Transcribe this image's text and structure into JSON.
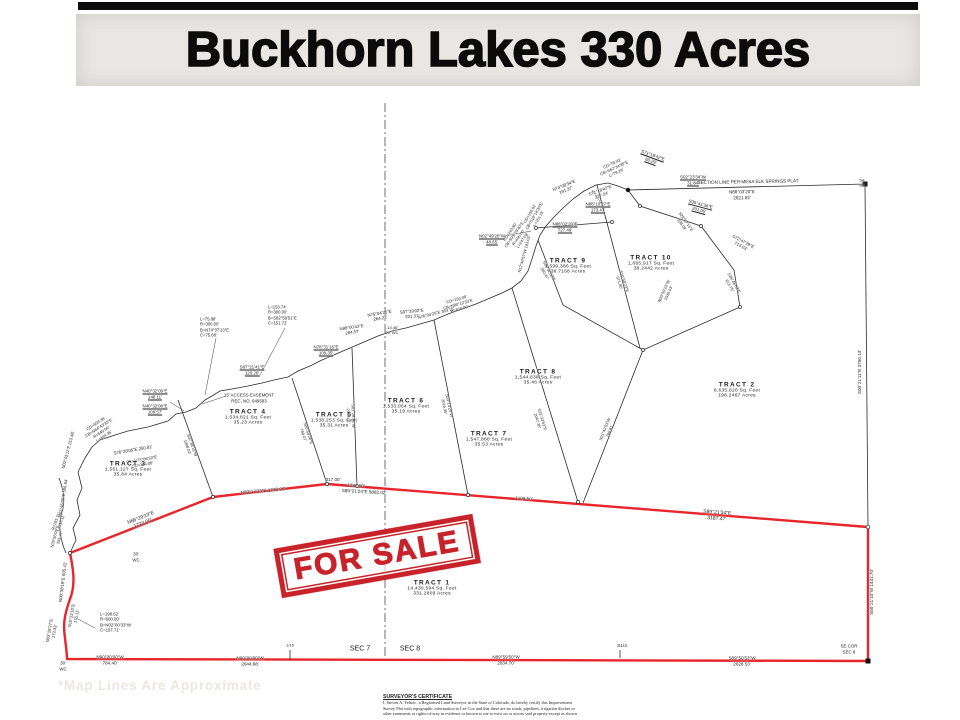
{
  "title": "Buckhorn Lakes 330 Acres",
  "stamp_text": "FOR SALE",
  "watermark": "*Map Lines Are Approximate",
  "colors": {
    "boundary_red": "#e8252a",
    "stamp_red": "#c8232a",
    "line_black": "#2a2a2a",
    "banner_gray": "#e9e7e3",
    "watermark_gray": "#ebe8e4"
  },
  "certificate": {
    "heading": "SURVEYOR'S CERTIFICATE",
    "lines": [
      "I, Steven A. Yelton , a Registered Land Surveyor in the State of Colorado, do hereby certify this Improvement",
      "Survey Plat with topographic information to Lee Cox and that there are no roads, pipelines, irrigation ditches or",
      "other easements or rights-of-way in evidence or known to me to exist on or across said property except as shown"
    ]
  },
  "tracts": [
    {
      "name": "TRACT  1",
      "sqft": "14,430,594  Sq. Feet",
      "acres": "331.2809  Acres",
      "x": 432,
      "y": 588
    },
    {
      "name": "TRACT  2",
      "sqft": "8,635,626  Sq. Feet",
      "acres": "198.2467  Acres",
      "x": 737,
      "y": 390
    },
    {
      "name": "TRACT  3",
      "sqft": "1,561,127  Sq. Feet",
      "acres": "35.84  Acres",
      "x": 128,
      "y": 469
    },
    {
      "name": "TRACT  4",
      "sqft": "1,534,821  Sq. Feet",
      "acres": "35.23  Acres",
      "x": 248,
      "y": 417
    },
    {
      "name": "TRACT  5",
      "sqft": "1,538,253  Sq. Feet",
      "acres": "35.31  Acres",
      "x": 334,
      "y": 420
    },
    {
      "name": "TRACT  6",
      "sqft": "1,533,054  Sq. Feet",
      "acres": "35.19  Acres",
      "x": 406,
      "y": 406
    },
    {
      "name": "TRACT  7",
      "sqft": "1,547,888  Sq. Feet",
      "acres": "35.53  Acres",
      "x": 489,
      "y": 439
    },
    {
      "name": "TRACT  8",
      "sqft": "1,544,838  Sq. Feet",
      "acres": "35.46  Acres",
      "x": 538,
      "y": 377
    },
    {
      "name": "TRACT  9",
      "sqft": "1,599,386  Sq. Feet",
      "acres": "36.7168  Acres",
      "x": 568,
      "y": 266
    },
    {
      "name": "TRACT 10",
      "sqft": "1,665,917  Sq. Feet",
      "acres": "38.2442  Acres",
      "x": 651,
      "y": 263
    }
  ],
  "labels": [
    {
      "t": "N66°29'23\"E\n1722.00'",
      "x": 142,
      "y": 521,
      "r": -21,
      "s": 5
    },
    {
      "t": "N89°17'33\"E  1236.98'",
      "x": 263,
      "y": 491,
      "r": -5,
      "s": 4.6
    },
    {
      "t": "317.00'",
      "x": 333,
      "y": 480,
      "r": 0,
      "s": 4.6
    },
    {
      "t": "1286.00'",
      "x": 356,
      "y": 486,
      "r": 3,
      "s": 4.6
    },
    {
      "t": "S89°21'24\"E  5882.02'",
      "x": 364,
      "y": 492,
      "r": 3,
      "s": 4.6
    },
    {
      "t": "1109.50'",
      "x": 524,
      "y": 499,
      "r": 3,
      "s": 4.6
    },
    {
      "t": "S89°21'34\"E\n3187.47'",
      "x": 717,
      "y": 516,
      "r": 4,
      "s": 5
    },
    {
      "t": "S00°21'10\"W  1441.70'",
      "x": 872,
      "y": 592,
      "r": -90,
      "s": 4.6
    },
    {
      "t": "S00°21'11\"E  3750.13'",
      "x": 860,
      "y": 372,
      "r": -90,
      "s": 4.6
    },
    {
      "t": "N90°00'00\"W\n784.40'",
      "x": 110,
      "y": 660,
      "r": 0,
      "s": 4.6
    },
    {
      "t": "N90°00'00\"W\n2644.88'",
      "x": 250,
      "y": 661,
      "r": 0,
      "s": 4.6
    },
    {
      "t": "N89°59'50\"W\n2834.70'",
      "x": 506,
      "y": 660,
      "r": 0,
      "s": 4.6
    },
    {
      "t": "S1/4",
      "x": 622,
      "y": 647,
      "r": 0,
      "s": 4.8
    },
    {
      "t": "S89°50'53\"W\n2628.53'",
      "x": 742,
      "y": 661,
      "r": 0,
      "s": 4.6
    },
    {
      "t": "SE  COR\nSEC  8",
      "x": 849,
      "y": 649,
      "r": 0,
      "s": 4.4
    },
    {
      "t": "SEC  7",
      "x": 360,
      "y": 650,
      "r": 0,
      "s": 7
    },
    {
      "t": "SEC  8",
      "x": 410,
      "y": 650,
      "r": 0,
      "s": 7
    },
    {
      "t": "30'\nWC",
      "x": 63,
      "y": 666,
      "r": 0,
      "s": 4.4
    },
    {
      "t": "1/16",
      "x": 290,
      "y": 646,
      "r": 0,
      "s": 3.8
    },
    {
      "t": "N00°38'19\"E  505.41'",
      "x": 63,
      "y": 582,
      "r": -83,
      "s": 4.4
    },
    {
      "t": "N10°23'10\"E\n175.11'",
      "x": 74,
      "y": 616,
      "r": -80,
      "s": 4.2
    },
    {
      "t": "N03°28'27\"E\n173.33'",
      "x": 52,
      "y": 631,
      "r": -80,
      "s": 4.2
    },
    {
      "t": "L=198.62'\nR=600.00'\nB=N02°00'33\"W\nC=197.71'",
      "x": 100,
      "y": 622,
      "r": 0,
      "s": 4.3,
      "a": "l"
    },
    {
      "t": "30'\nWC",
      "x": 136,
      "y": 557,
      "r": 0,
      "s": 4.4
    },
    {
      "t": "R=281.31'\nL=216.11'",
      "x": 58,
      "y": 522,
      "r": -70,
      "s": 4
    },
    {
      "t": "N03°46'00\"E  506.94'",
      "x": 63,
      "y": 498,
      "r": -80,
      "s": 4.2
    },
    {
      "t": "N02°43'11\"E  213.48'",
      "x": 68,
      "y": 450,
      "r": -75,
      "s": 4.2
    },
    {
      "t": "N25°56'09\"E\n355.47'",
      "x": 57,
      "y": 537,
      "r": -75,
      "s": 4
    },
    {
      "t": "CD=503.36'\nCB=N64°43'33\"E\nR=540.00'\nL=444.35'",
      "x": 100,
      "y": 430,
      "r": -33,
      "s": 4.1
    },
    {
      "t": "S76°20'05\"E  250.81'",
      "x": 133,
      "y": 450,
      "r": -10,
      "s": 4.3
    },
    {
      "t": "CB=N73°06'33\"E\nCD=314.08'",
      "x": 142,
      "y": 462,
      "r": -10,
      "s": 4.1
    },
    {
      "t": "N40°32'09\"E\n148.11'",
      "x": 155,
      "y": 394,
      "r": 0,
      "s": 4.4,
      "u": 1
    },
    {
      "t": "N40°32'08\"E\n109.57'",
      "x": 155,
      "y": 409,
      "r": 0,
      "s": 4.4,
      "u": 1
    },
    {
      "t": "S87°21'41\"E\n120.26'",
      "x": 252,
      "y": 370,
      "r": 0,
      "s": 4.4,
      "u": 1
    },
    {
      "t": "15' ACCESS EASEMENT\nREC. NO. 949583",
      "x": 249,
      "y": 398,
      "r": 0,
      "s": 4.4
    },
    {
      "t": "L=75.88'\nR=300.00'\nB=N74°07'13\"E\nC=75.68'",
      "x": 200,
      "y": 327,
      "r": 0,
      "s": 4.2,
      "a": "l"
    },
    {
      "t": "L=153.74'\nR=300.00'\nB=S82°59'51\"E\nC=151.72'",
      "x": 268,
      "y": 315,
      "r": 0,
      "s": 4.2,
      "a": "l"
    },
    {
      "t": "N78°31'16\"E\n109.35'",
      "x": 326,
      "y": 350,
      "r": 0,
      "s": 4.4,
      "u": 1
    },
    {
      "t": "N88°00'43\"E\n284.57'",
      "x": 352,
      "y": 330,
      "r": -8,
      "s": 4.3
    },
    {
      "t": "N75°04'25\"E\n264.22'",
      "x": 380,
      "y": 316,
      "r": -10,
      "s": 4.3
    },
    {
      "t": "S87°39'02\"E\n201.31'",
      "x": 412,
      "y": 314,
      "r": -5,
      "s": 4.3
    },
    {
      "t": "-13.46'\n20' WC",
      "x": 392,
      "y": 330,
      "r": 0,
      "s": 4
    },
    {
      "t": "N76°04'25\"E  364.15'",
      "x": 436,
      "y": 313,
      "r": -14,
      "s": 4.1
    },
    {
      "t": "CD=150.08'\nCB=N80°12'33\"E\nR=450.00'",
      "x": 458,
      "y": 304,
      "r": -16,
      "s": 4
    },
    {
      "t": "N02°49'20\"W\n48.65'",
      "x": 492,
      "y": 239,
      "r": 0,
      "s": 4.4,
      "u": 1
    },
    {
      "t": "N88°02'20\"E\n727.49'",
      "x": 565,
      "y": 227,
      "r": 0,
      "s": 4.4,
      "u": 1
    },
    {
      "t": "CD=243.80'\nCB=S35°29'40\"E\nR=450.00'\nL=247.08'",
      "x": 516,
      "y": 236,
      "r": -55,
      "s": 4
    },
    {
      "t": "CD=150.02'\nCB=S16°14'30\"E\nL=151.25'",
      "x": 534,
      "y": 216,
      "r": -60,
      "s": 4
    },
    {
      "t": "N12°40'57\"W  103.03'",
      "x": 524,
      "y": 254,
      "r": -75,
      "s": 4
    },
    {
      "t": "N74°08'34\"E\n191.37'",
      "x": 565,
      "y": 188,
      "r": -22,
      "s": 4.3
    },
    {
      "t": "S71°18'42\"E\n227.24'",
      "x": 601,
      "y": 193,
      "r": -20,
      "s": 4.3
    },
    {
      "t": "CD=78.03'\nCB=S62°34'35\"E\nL=79.29'",
      "x": 614,
      "y": 168,
      "r": -25,
      "s": 4
    },
    {
      "t": "N88°10'27\"E\n173.47'",
      "x": 598,
      "y": 207,
      "r": 0,
      "s": 4.4,
      "u": 1
    },
    {
      "t": "S71°18'42\"E\n60.29'",
      "x": 652,
      "y": 158,
      "r": 20,
      "s": 4.4,
      "u": 1
    },
    {
      "t": "S02°23'34\"W\n31.84'",
      "x": 693,
      "y": 180,
      "r": 0,
      "s": 4.4,
      "u": 1
    },
    {
      "t": "S35°41'36\"E\n201.05'",
      "x": 700,
      "y": 207,
      "r": 15,
      "s": 4.4,
      "u": 1
    },
    {
      "t": "S28°07'15\"E\n238.09'",
      "x": 684,
      "y": 223,
      "r": 55,
      "s": 4
    },
    {
      "t": "S72°47'29\"E\n713.03'",
      "x": 742,
      "y": 244,
      "r": 28,
      "s": 4.3
    },
    {
      "t": "SECTION LINE PER MESA ELK SPRINGS PLAT",
      "x": 748,
      "y": 182,
      "r": -1,
      "s": 4.6
    },
    {
      "t": "N88°03'20\"E\n2621.82'",
      "x": 742,
      "y": 195,
      "r": -1,
      "s": 4.6
    },
    {
      "t": "5|4\n8|9",
      "x": 862,
      "y": 183,
      "r": 0,
      "s": 3.8
    },
    {
      "t": "S02°38'19\"W\n1008.02'",
      "x": 190,
      "y": 446,
      "r": 70,
      "s": 4
    },
    {
      "t": "S00°54'26\"E\n769.07'",
      "x": 306,
      "y": 434,
      "r": 72,
      "s": 4
    },
    {
      "t": "S01°28'30\"W\n2019.41'",
      "x": 351,
      "y": 416,
      "r": 88,
      "s": 4
    },
    {
      "t": "S03°13'24\"W\n2016.35'",
      "x": 447,
      "y": 406,
      "r": 78,
      "s": 4
    },
    {
      "t": "S22°33'53\"E\n2047.35'",
      "x": 540,
      "y": 420,
      "r": 73,
      "s": 4
    },
    {
      "t": "N21°42'53\"W\n766.81'",
      "x": 607,
      "y": 430,
      "r": -68,
      "s": 4
    },
    {
      "t": "N30°50'23\"W\n1030.03'",
      "x": 666,
      "y": 292,
      "r": -66,
      "s": 4
    },
    {
      "t": "S10°58'23\"E\n571.80'",
      "x": 622,
      "y": 282,
      "r": 72,
      "s": 4
    },
    {
      "t": "S36°46'03\"E\n613.75'",
      "x": 732,
      "y": 284,
      "r": 60,
      "s": 4
    },
    {
      "t": "S46°32'33\"E\n380.47'",
      "x": 547,
      "y": 272,
      "r": 60,
      "s": 4
    }
  ]
}
